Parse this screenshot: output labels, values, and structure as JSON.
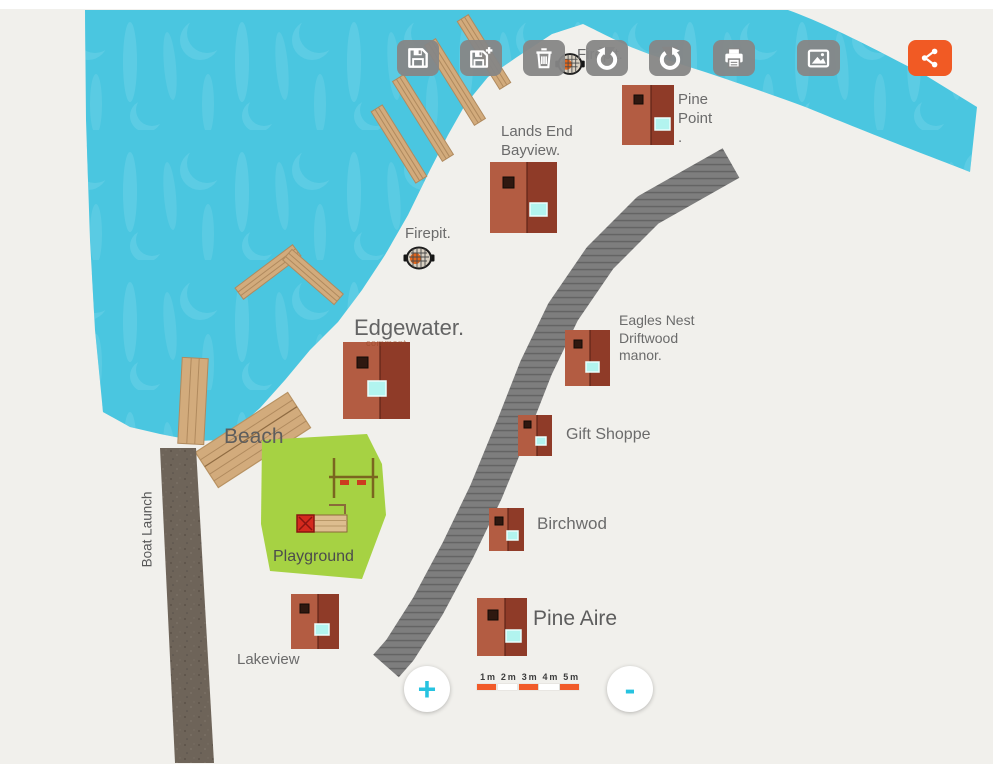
{
  "toolbar": {
    "buttons": [
      {
        "id": "save",
        "icon": "floppy-disk-icon"
      },
      {
        "id": "save-as",
        "icon": "floppy-disk-plus-icon"
      },
      {
        "id": "delete",
        "icon": "trash-icon"
      },
      {
        "id": "undo",
        "icon": "undo-rotate-left-icon"
      },
      {
        "id": "redo",
        "icon": "redo-rotate-right-icon"
      },
      {
        "id": "print",
        "icon": "printer-icon"
      },
      {
        "id": "export-image",
        "icon": "image-icon"
      },
      {
        "id": "share",
        "icon": "share-icon"
      }
    ]
  },
  "map": {
    "labels": {
      "pine_point": "Pine\nPoint\n.",
      "lands_end": "Lands End\nBayview.",
      "firepit": "Firepit.",
      "firepit_hidden": "Firepit.",
      "edgewater": "Edgewater.",
      "comment": "comment",
      "eagles_nest": "Eagles Nest\nDriftwood\nmanor.",
      "gift_shoppe": "Gift Shoppe",
      "birchwod": "Birchwod",
      "pine_aire": "Pine Aire",
      "lakeview": "Lakeview",
      "beach": "Beach",
      "playground": "Playground",
      "boat_launch": "Boat Launch"
    },
    "features": [
      "lake",
      "docks",
      "gravel-boardwalk-path",
      "boat-launch-road",
      "playground-area",
      "cabins",
      "firepit-markers",
      "swing-set",
      "slide"
    ]
  },
  "scale_bar": {
    "labels": [
      "1 m",
      "2 m",
      "3 m",
      "4 m",
      "5 m"
    ],
    "segment_colors": [
      "#f15a29",
      "#ffffff",
      "#f15a29",
      "#ffffff",
      "#f15a29"
    ]
  },
  "zoom_controls": {
    "zoom_in_label": "+",
    "zoom_out_label": "-",
    "accent": "#27c3e0"
  },
  "colors": {
    "water": "#4ac6e0",
    "water_pattern": "#73d4e8",
    "paper": "#f1f0ec",
    "dock_wood": "#d2ab7c",
    "path_gray": "#7e7e7e",
    "road_gravel": "#6e6459",
    "grass": "#a6d243",
    "cabin_light": "#b35c42",
    "cabin_dark": "#8f3b28",
    "cabin_window": "#b2f4ef",
    "toolbar_button": "#868686",
    "share_orange": "#f15a24",
    "scale_orange": "#f15a29"
  }
}
